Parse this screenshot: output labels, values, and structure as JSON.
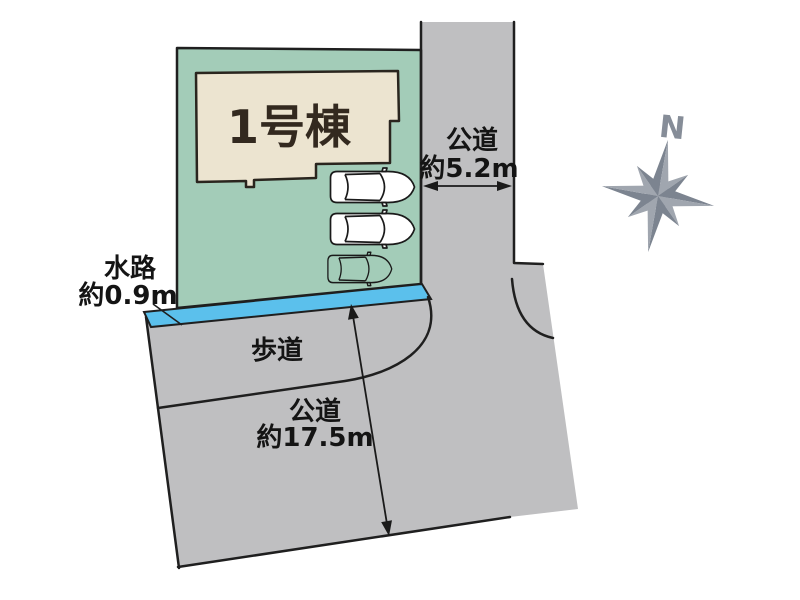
{
  "building": {
    "label": "1号棟"
  },
  "road_right": {
    "name": "公道",
    "width": "約5.2m"
  },
  "waterway": {
    "name": "水路",
    "width": "約0.9m"
  },
  "sidewalk": {
    "name": "歩道"
  },
  "road_bottom": {
    "name": "公道",
    "length": "約17.5m"
  },
  "compass": {
    "north_label": "N"
  },
  "colors": {
    "plot_green": "#a3ccb8",
    "building_beige": "#ece4d0",
    "road_gray": "#bfbfc1",
    "waterway_blue": "#5bc0ec",
    "compass_light": "#a0a6af",
    "compass_dark": "#7c8490"
  }
}
